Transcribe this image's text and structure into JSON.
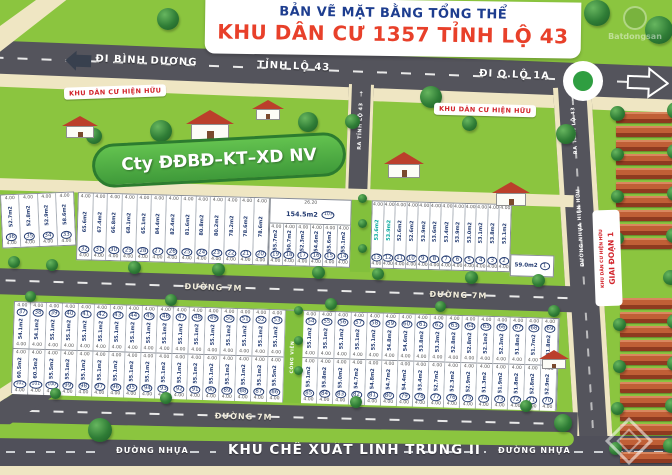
{
  "title": {
    "line1": "BẢN VẼ MẶT BẰNG TỔNG THỂ",
    "line2": "KHU DÂN CƯ 1357 TỈNH LỘ 43"
  },
  "colors": {
    "green": "#8bc53f",
    "road": "#54545c",
    "sidewalk": "#efe6c3",
    "navy": "#1d3d8f",
    "red": "#e8402a",
    "teal": "#00a79d",
    "lot_text": "#223a70"
  },
  "roads": {
    "di_binh_duong": "ĐI BÌNH DƯƠNG",
    "tinh_lo_43": "TỈNH LỘ 43",
    "di_q_lo_1a": "ĐI Q.LỘ 1A",
    "duong_7m": "ĐƯỜNG 7M",
    "ra_tinh_lo_43": "RA TỈNH LỘ 43",
    "duong_nhua_hien_huu": "ĐƯỜNG NHỰA HIỆN HỮU",
    "duong_nhua": "ĐƯỜNG NHỰA",
    "khu_che_xuat": "KHU CHẾ XUẤT LINH TRUNG II",
    "arrow_up": "↑"
  },
  "areas_labels": {
    "khu_dan_cu_hien_huu": "KHU DÂN CƯ HIỆN HỮU",
    "cong_vien": "CÔNG VIÊN",
    "giai_doan_1": "GIAI ĐOẠN 1",
    "cty": "Cty ĐĐBĐ–KT–XD NV",
    "watermark": "Batdongsan"
  },
  "lot_defaults": {
    "dim": "4.00"
  },
  "blocks": {
    "upper_left": [
      {
        "no": "36",
        "area": "52.7m2"
      },
      {
        "no": "35",
        "area": "52.8m2"
      },
      {
        "no": "34",
        "area": "52.9m2"
      },
      {
        "no": "33",
        "area": "58.6m2"
      }
    ],
    "upper_mid": [
      {
        "no": "32",
        "area": "65.6m2"
      },
      {
        "no": "31",
        "area": "67.4m2"
      },
      {
        "no": "30",
        "area": "66.8m2"
      },
      {
        "no": "29",
        "area": "68.1m2"
      },
      {
        "no": "28",
        "area": "65.1m2"
      },
      {
        "no": "27",
        "area": "84.4m2"
      },
      {
        "no": "26",
        "area": "82.4m2"
      },
      {
        "no": "25",
        "area": "81.6m2"
      },
      {
        "no": "24",
        "area": "80.8m2"
      },
      {
        "no": "23",
        "area": "80.2m2"
      },
      {
        "no": "22",
        "area": "78.2m2"
      },
      {
        "no": "21",
        "area": "78.6m2"
      },
      {
        "no": "20",
        "area": "78.6m2"
      }
    ],
    "big_lot": {
      "no": "103",
      "area": "154.5m2",
      "dim": "26.20"
    },
    "upper_under_big": [
      {
        "no": "19",
        "area": "55.7m2"
      },
      {
        "no": "18",
        "area": "50.7m2"
      },
      {
        "no": "17",
        "area": "52.3m2"
      },
      {
        "no": "16",
        "area": "54.6m2"
      },
      {
        "no": "15",
        "area": "55.6m2"
      },
      {
        "no": "14",
        "area": "55.1m2"
      }
    ],
    "upper_right": [
      {
        "no": "13",
        "area": "53.6m2",
        "teal": true
      },
      {
        "no": "12",
        "area": "53.9m2",
        "teal": true
      },
      {
        "no": "11",
        "area": "52.6m2"
      },
      {
        "no": "10",
        "area": "52.6m2"
      },
      {
        "no": "9",
        "area": "53.9m2"
      },
      {
        "no": "8",
        "area": "53.6m2"
      },
      {
        "no": "7",
        "area": "53.4m2"
      },
      {
        "no": "6",
        "area": "53.9m2"
      },
      {
        "no": "5",
        "area": "53.0m2"
      },
      {
        "no": "4",
        "area": "53.1m2"
      },
      {
        "no": "3",
        "area": "53.8m2"
      },
      {
        "no": "2",
        "area": "53.1m2"
      }
    ],
    "lot_1": {
      "no": "1",
      "area": "59.0m2"
    },
    "lower_top_left": [
      {
        "no": "37",
        "area": "54.1m2"
      },
      {
        "no": "38",
        "area": "54.1m2"
      },
      {
        "no": "39",
        "area": "55.1m2"
      },
      {
        "no": "40",
        "area": "55.1m2"
      },
      {
        "no": "41",
        "area": "55.1m2"
      },
      {
        "no": "42",
        "area": "55.1m2"
      },
      {
        "no": "43",
        "area": "55.1m2"
      },
      {
        "no": "44",
        "area": "55.1m2"
      },
      {
        "no": "45",
        "area": "55.1m2"
      },
      {
        "no": "46",
        "area": "55.1m2"
      },
      {
        "no": "47",
        "area": "55.1m2"
      },
      {
        "no": "48",
        "area": "55.1m2"
      },
      {
        "no": "49",
        "area": "55.1m2"
      },
      {
        "no": "50",
        "area": "55.1m2"
      },
      {
        "no": "51",
        "area": "55.1m2"
      },
      {
        "no": "52",
        "area": "55.1m2"
      },
      {
        "no": "53",
        "area": "55.1m2"
      }
    ],
    "lower_top_right": [
      {
        "no": "54",
        "area": "55.1m2"
      },
      {
        "no": "55",
        "area": "55.1m2"
      },
      {
        "no": "56",
        "area": "55.1m2"
      },
      {
        "no": "57",
        "area": "55.1m2"
      },
      {
        "no": "58",
        "area": "55.1m2"
      },
      {
        "no": "59",
        "area": "54.8m2"
      },
      {
        "no": "60",
        "area": "54.6m2"
      },
      {
        "no": "61",
        "area": "53.8m2"
      },
      {
        "no": "62",
        "area": "53.3m2"
      },
      {
        "no": "63",
        "area": "52.8m2"
      },
      {
        "no": "64",
        "area": "52.8m2"
      },
      {
        "no": "65",
        "area": "52.1m2"
      },
      {
        "no": "66",
        "area": "52.3m2"
      },
      {
        "no": "67",
        "area": "51.8m2"
      },
      {
        "no": "68",
        "area": "51.7m2"
      },
      {
        "no": "69",
        "area": "51.8m2"
      }
    ],
    "lower_bottom_left": [
      {
        "no": "102",
        "area": "60.5m2"
      },
      {
        "no": "101",
        "area": "60.5m2"
      },
      {
        "no": "100",
        "area": "55.5m2"
      },
      {
        "no": "99",
        "area": "55.1m2"
      },
      {
        "no": "98",
        "area": "55.1m2"
      },
      {
        "no": "97",
        "area": "55.1m2"
      },
      {
        "no": "96",
        "area": "55.1m2"
      },
      {
        "no": "95",
        "area": "55.1m2"
      },
      {
        "no": "94",
        "area": "55.1m2"
      },
      {
        "no": "93",
        "area": "55.1m2"
      },
      {
        "no": "92",
        "area": "55.1m2"
      },
      {
        "no": "91",
        "area": "55.1m2"
      },
      {
        "no": "90",
        "area": "55.1m2"
      },
      {
        "no": "89",
        "area": "55.1m2"
      },
      {
        "no": "88",
        "area": "55.1m2"
      },
      {
        "no": "87",
        "area": "55.1m2"
      },
      {
        "no": "86",
        "area": "55.5m2"
      }
    ],
    "lower_bottom_right": [
      {
        "no": "85",
        "area": "55.1m2"
      },
      {
        "no": "84",
        "area": "55.8m2"
      },
      {
        "no": "83",
        "area": "55.0m2"
      },
      {
        "no": "82",
        "area": "54.7m2"
      },
      {
        "no": "81",
        "area": "54.8m2"
      },
      {
        "no": "80",
        "area": "54.7m2"
      },
      {
        "no": "79",
        "area": "54.4m2"
      },
      {
        "no": "78",
        "area": "53.4m2"
      },
      {
        "no": "77",
        "area": "52.7m2"
      },
      {
        "no": "76",
        "area": "52.3m2"
      },
      {
        "no": "75",
        "area": "52.9m2"
      },
      {
        "no": "74",
        "area": "51.3m2"
      },
      {
        "no": "73",
        "area": "51.9m2"
      },
      {
        "no": "72",
        "area": "51.8m2"
      },
      {
        "no": "71",
        "area": "52.8m2"
      },
      {
        "no": "70",
        "area": "52.9m2"
      }
    ]
  }
}
